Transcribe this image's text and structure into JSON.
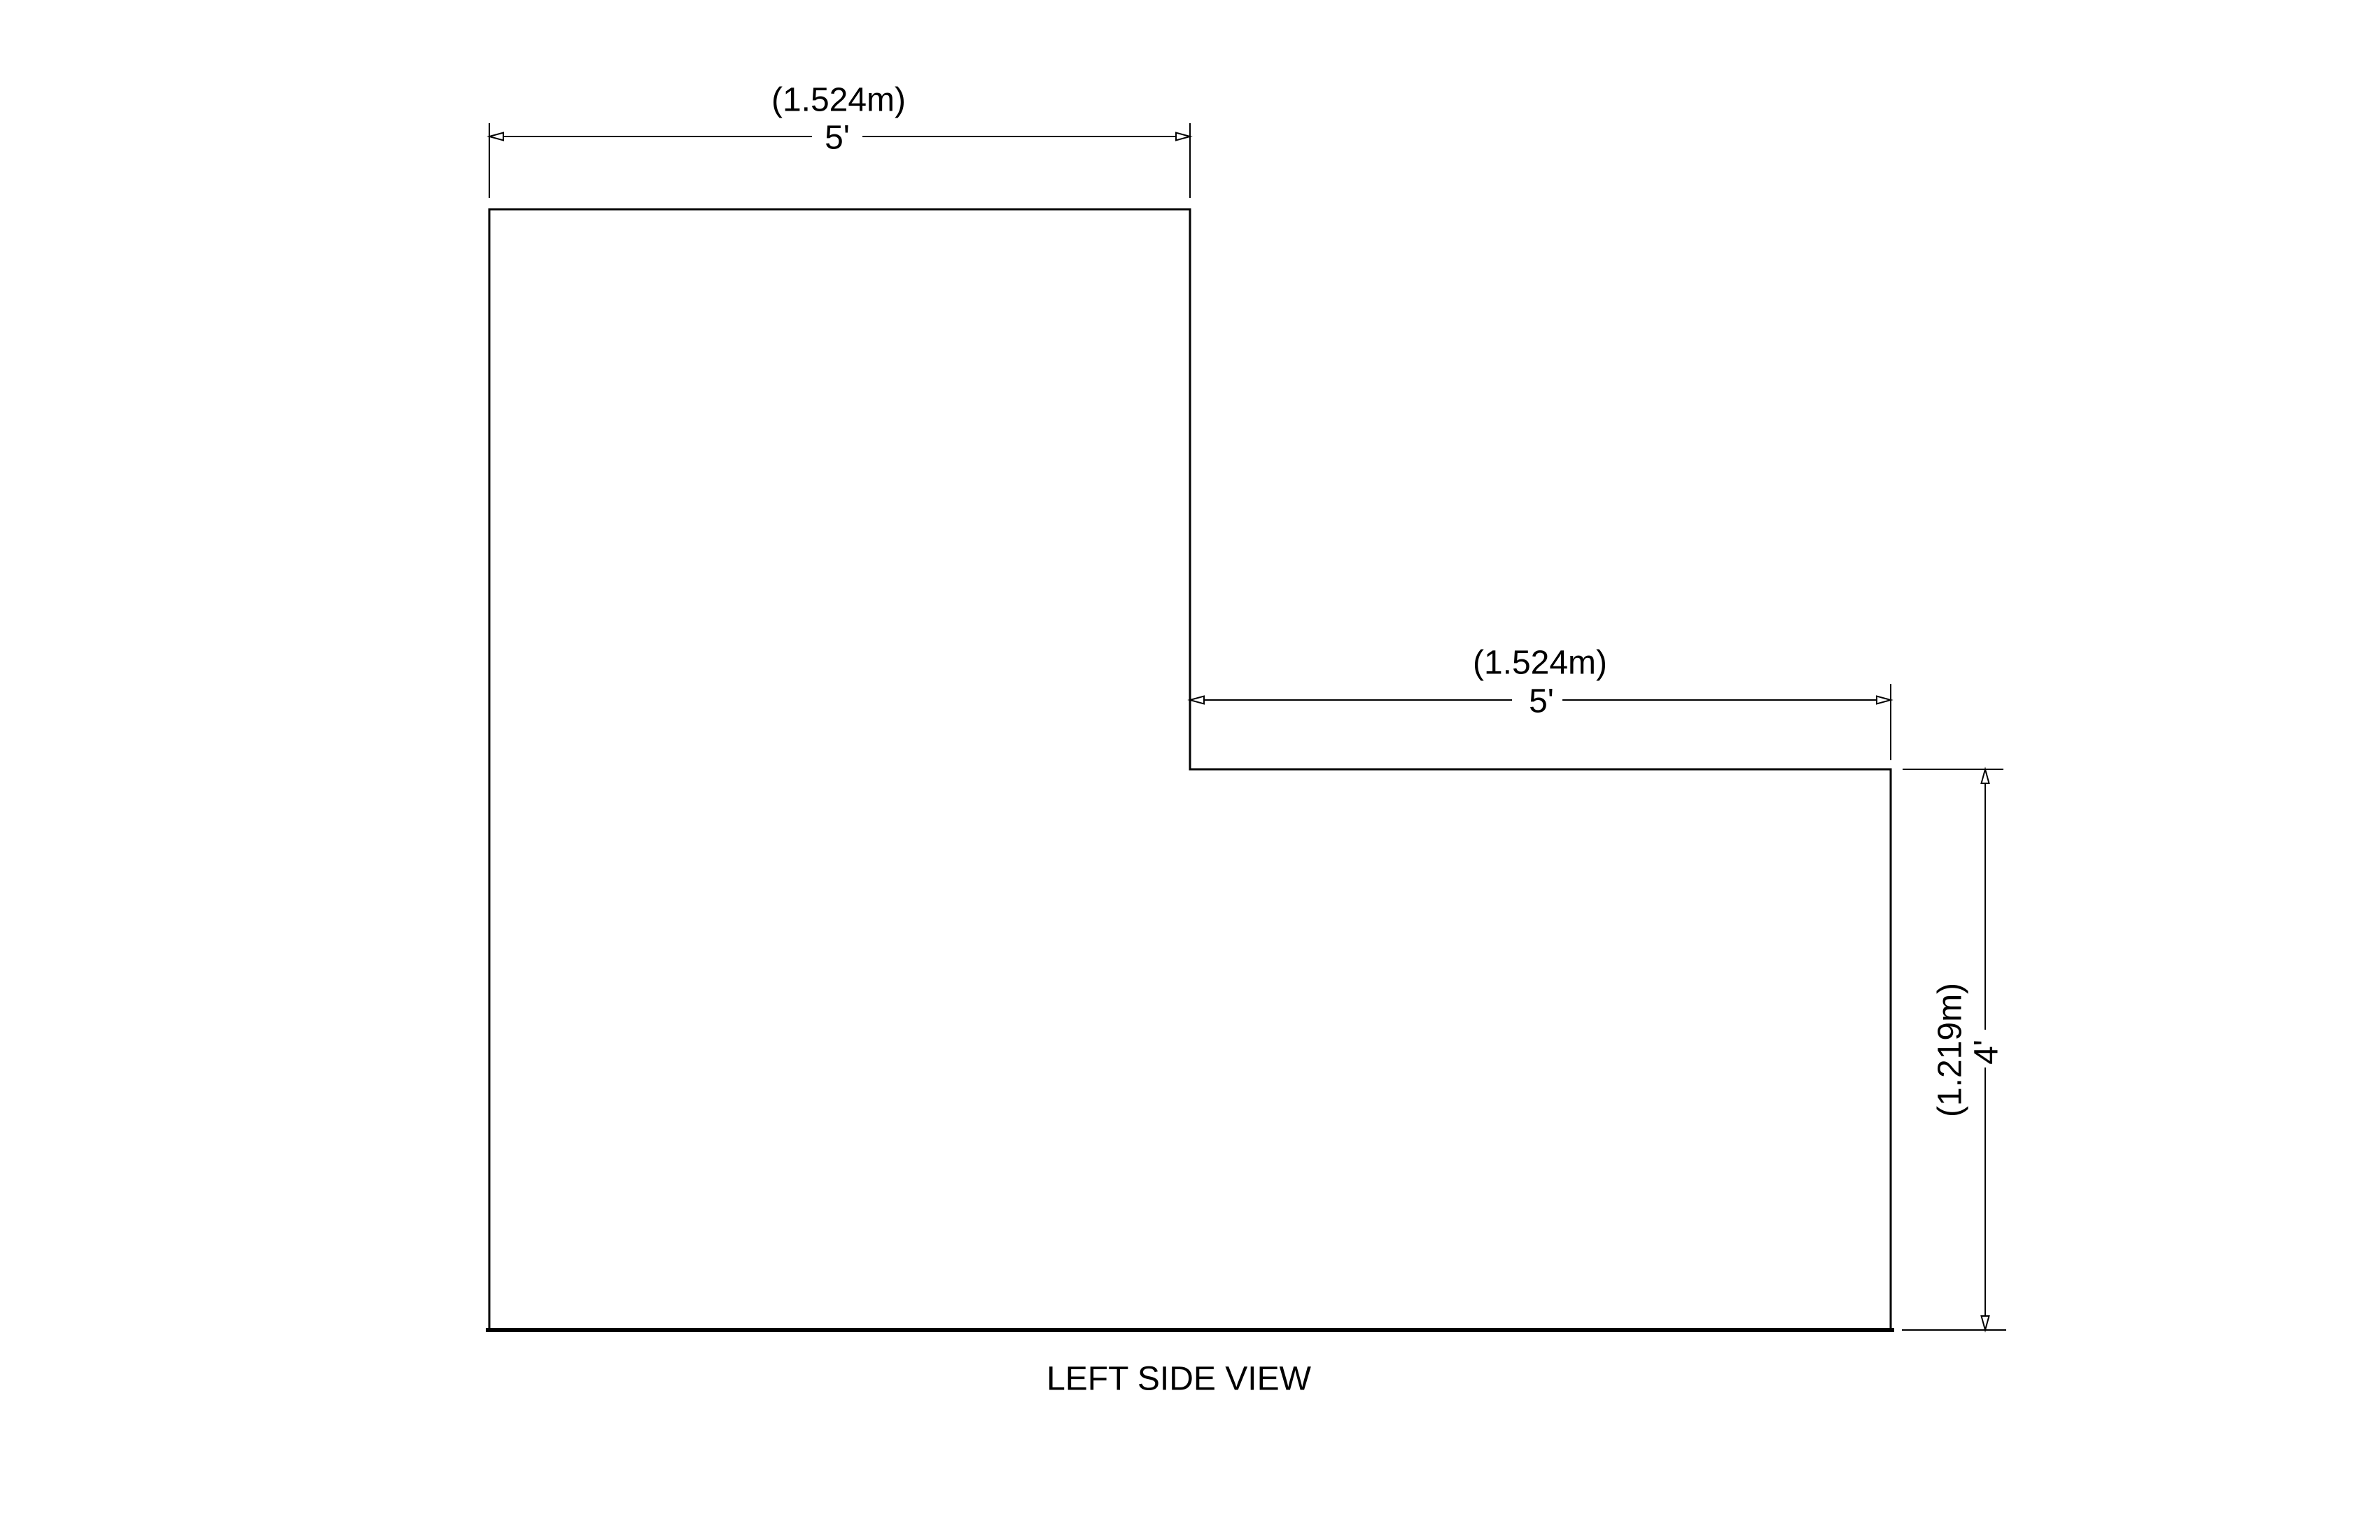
{
  "drawing": {
    "view_label": "LEFT SIDE VIEW",
    "dims": {
      "top": {
        "metric": "(1.524m)",
        "imperial": "5'"
      },
      "step": {
        "metric": "(1.524m)",
        "imperial": "5'"
      },
      "right": {
        "metric": "(1.219m)",
        "imperial": "4'"
      }
    },
    "colors": {
      "line": "#000000",
      "text": "#000000",
      "background": "#ffffff"
    }
  }
}
